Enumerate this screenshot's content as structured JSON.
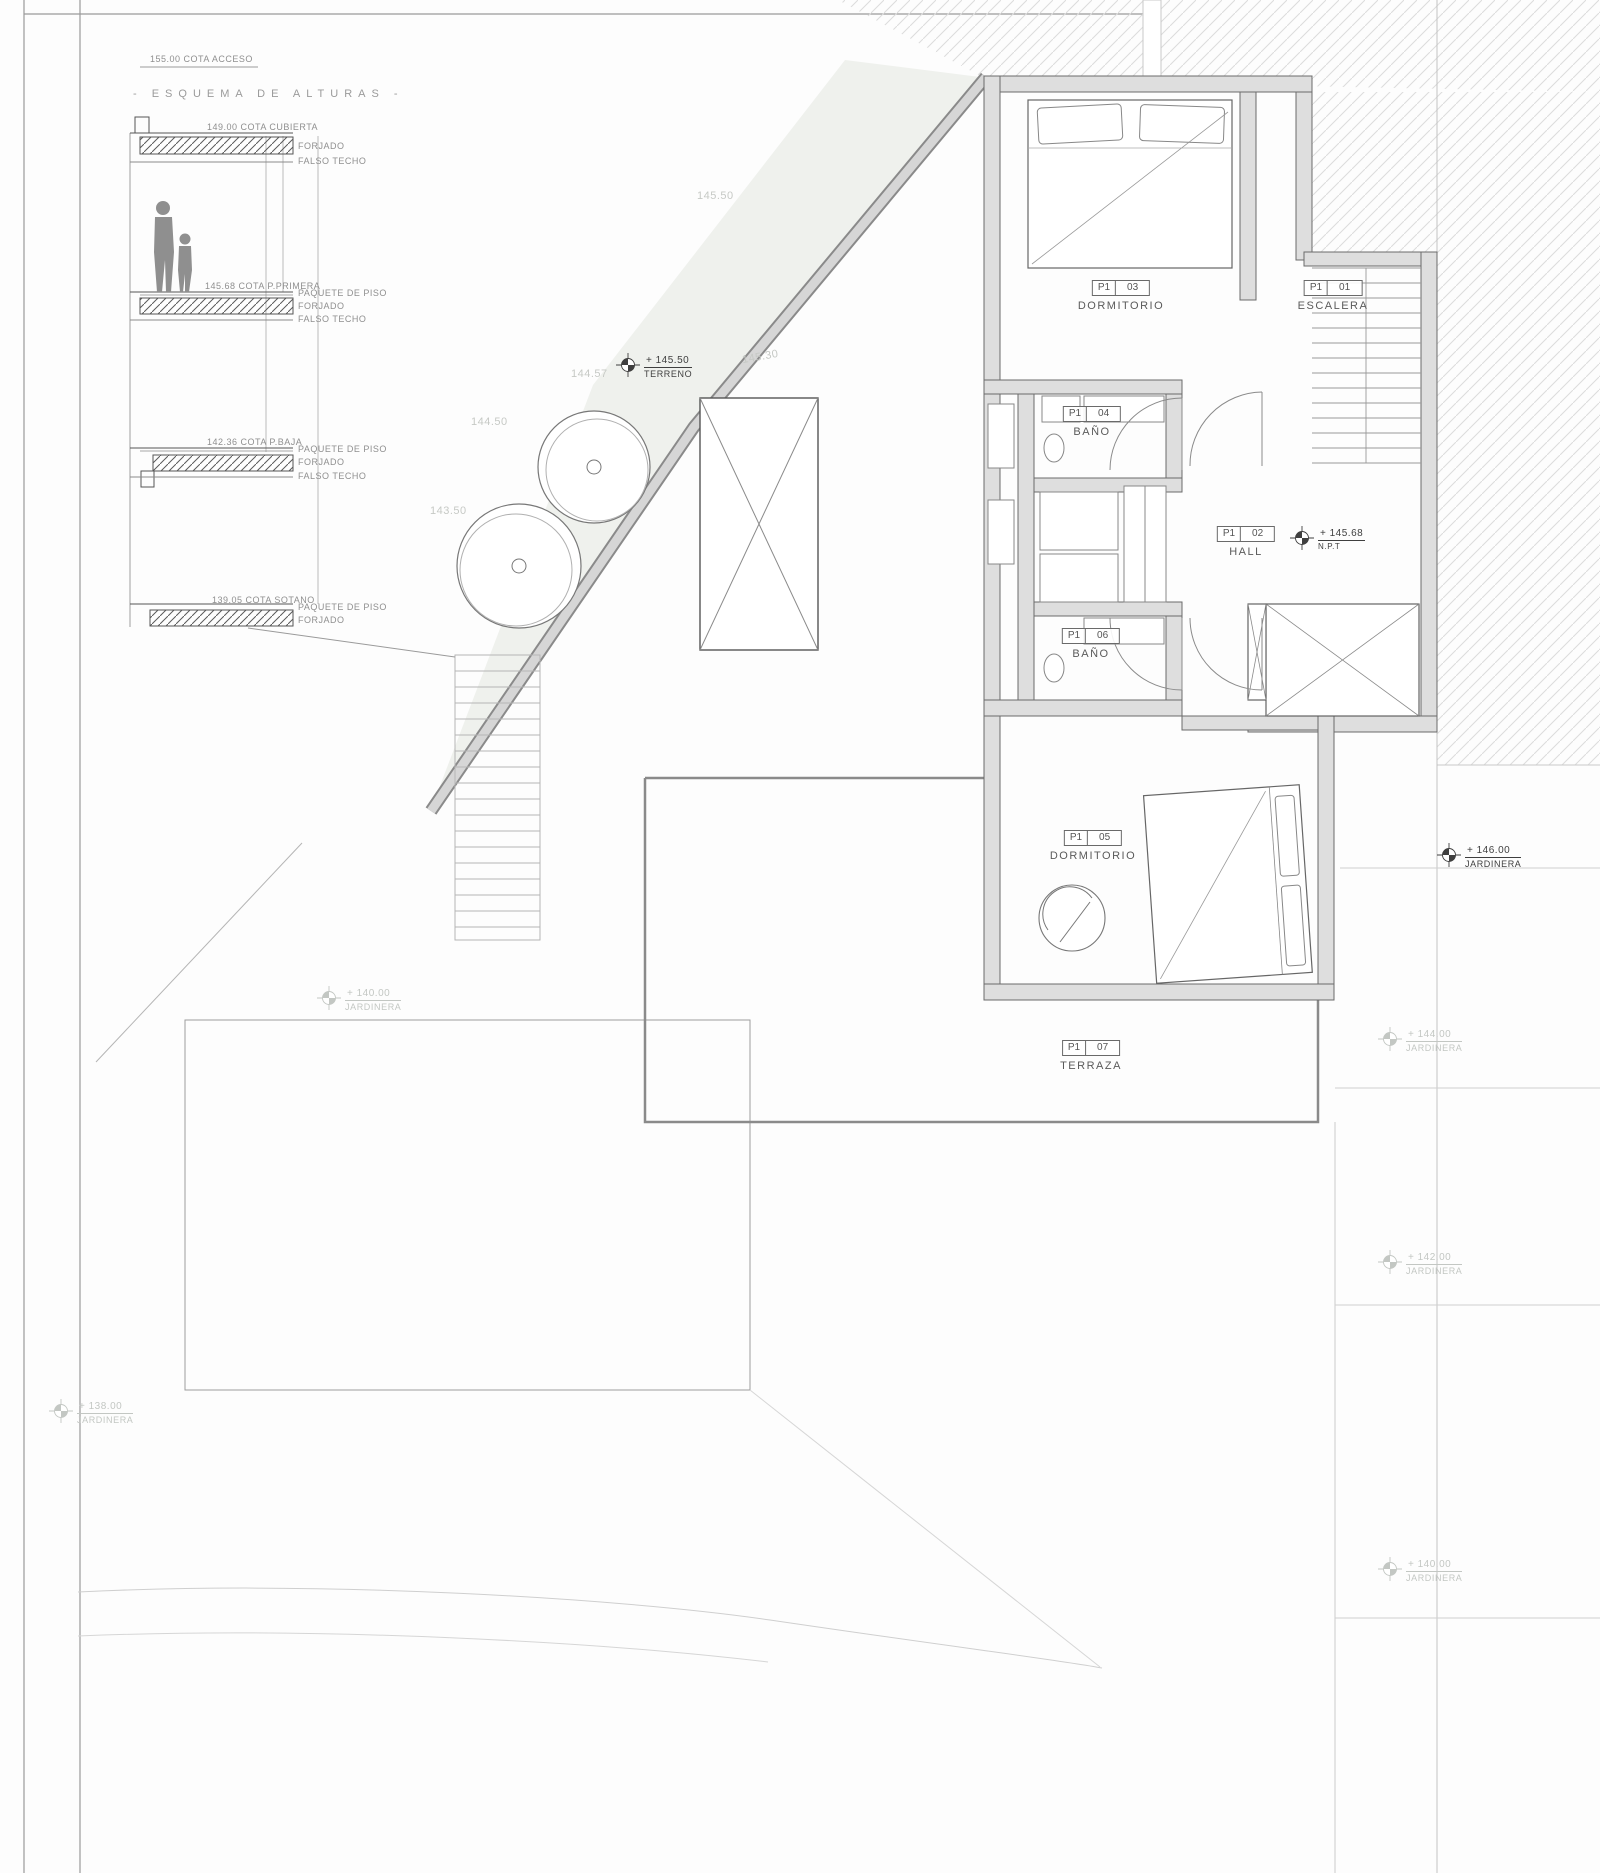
{
  "esquema": {
    "cota_acceso": "155.00 COTA ACCESO",
    "title": "- ESQUEMA DE ALTURAS -",
    "cubierta_cota": "149.00 COTA CUBIERTA",
    "cubierta_l1": "FORJADO",
    "cubierta_l2": "FALSO TECHO",
    "primera_cota": "145.68 COTA P.PRIMERA",
    "primera_l1": "PAQUETE DE PISO",
    "primera_l2": "FORJADO",
    "primera_l3": "FALSO TECHO",
    "baja_cota": "142.36 COTA P.BAJA",
    "baja_l1": "PAQUETE DE PISO",
    "baja_l2": "FORJADO",
    "baja_l3": "FALSO TECHO",
    "sotano_cota": "139.05 COTA SOTANO",
    "sotano_l1": "PAQUETE DE PISO",
    "sotano_l2": "FORJADO"
  },
  "rooms": [
    {
      "prefix": "P1",
      "num": "03",
      "name": "DORMITORIO"
    },
    {
      "prefix": "P1",
      "num": "01",
      "name": "ESCALERA"
    },
    {
      "prefix": "P1",
      "num": "04",
      "name": "BAÑO"
    },
    {
      "prefix": "P1",
      "num": "02",
      "name": "HALL"
    },
    {
      "prefix": "P1",
      "num": "06",
      "name": "BAÑO"
    },
    {
      "prefix": "P1",
      "num": "05",
      "name": "DORMITORIO"
    },
    {
      "prefix": "P1",
      "num": "07",
      "name": "TERRAZA"
    }
  ],
  "levels": {
    "terreno_value": "+ 145.50",
    "terreno_label": "TERRENO",
    "npt_value": "+ 145.68",
    "npt_label": "N.P.T",
    "jardinera_main_value": "+ 146.00",
    "jardinera_main_label": "JARDINERA",
    "jardinera_left_value": "+ 140.00",
    "jardinera_left_label": "JARDINERA",
    "jardinera_r1_value": "+ 144.00",
    "jardinera_r1_label": "JARDINERA",
    "jardinera_r2_value": "+ 142.00",
    "jardinera_r2_label": "JARDINERA",
    "jardinera_r3_value": "+ 140.00",
    "jardinera_r3_label": "JARDINERA",
    "jardinera_bl_value": "+ 138.00",
    "jardinera_bl_label": "JARDINERA"
  },
  "contours": {
    "c1": "145.50",
    "c2": "144.57",
    "c3": "145.30",
    "c4": "144.50",
    "c5": "143.50"
  },
  "colors": {
    "ink": "#4a4a4a",
    "wall_fill": "#dedede",
    "hatch_light": "#dcdcdc",
    "terrain_fill": "#eff1ed",
    "faint": "#c3c7c3"
  }
}
